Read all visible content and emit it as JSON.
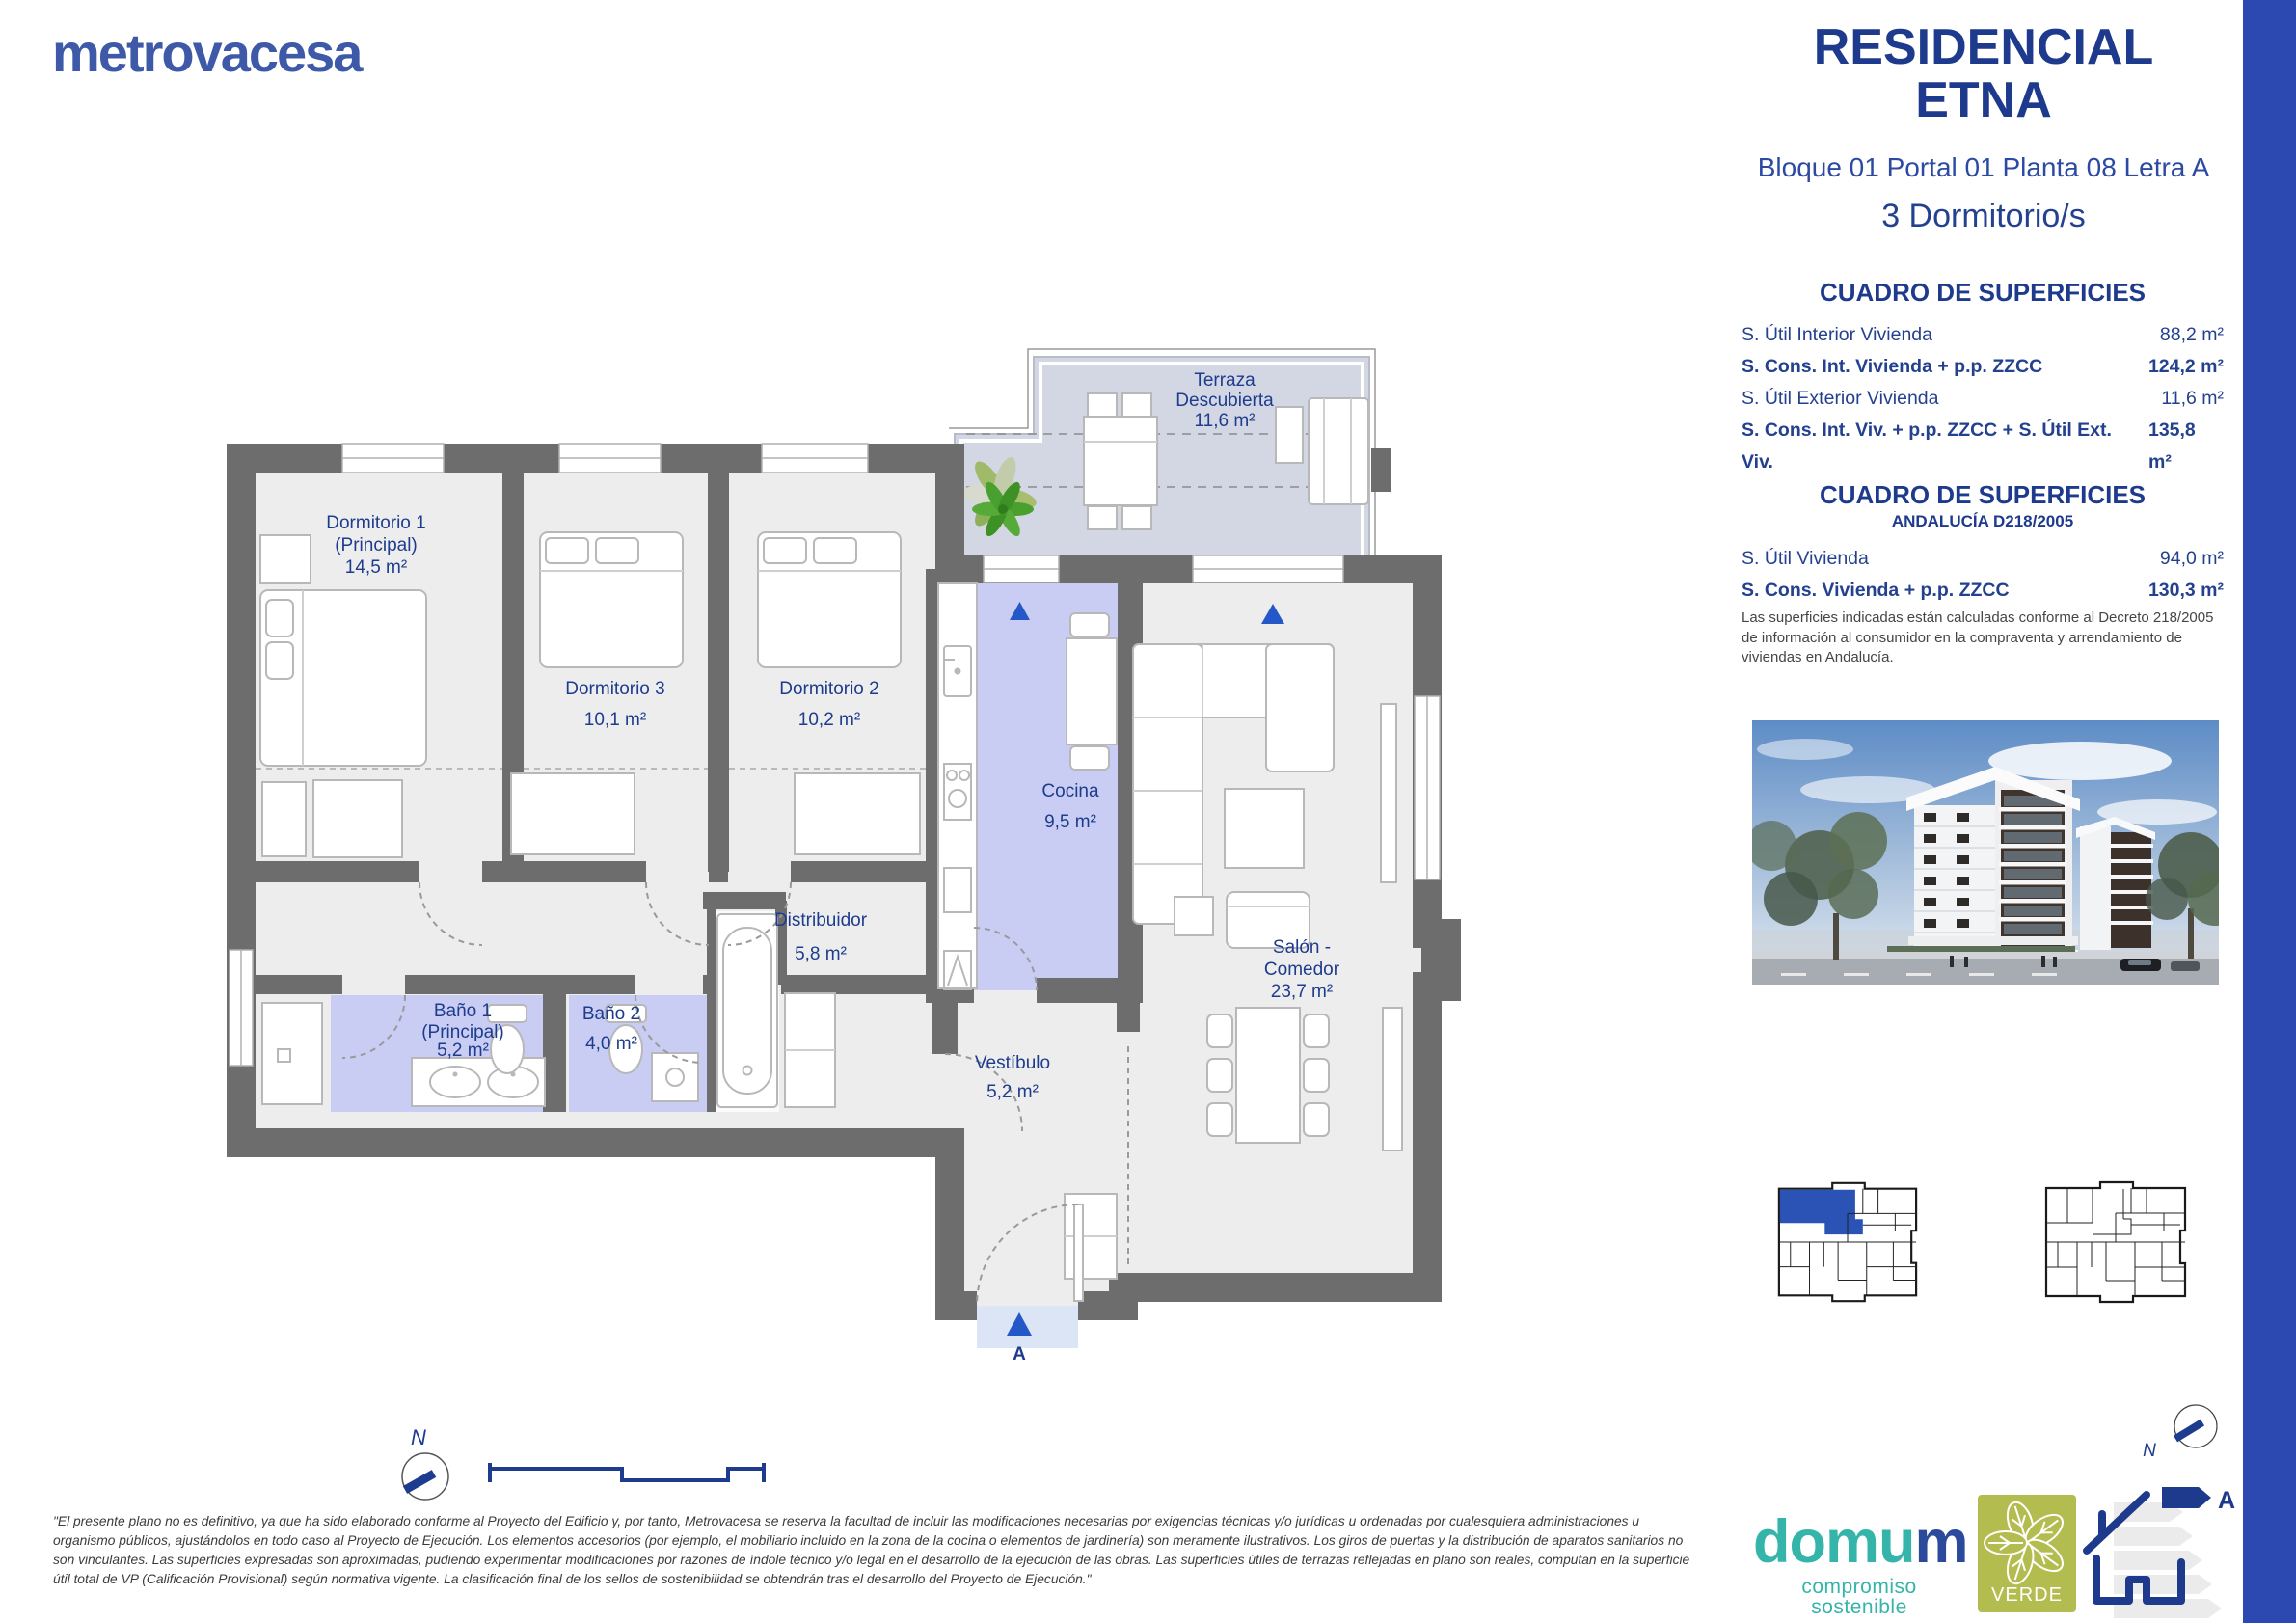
{
  "brand": {
    "logo_text": "metrovacesa"
  },
  "header": {
    "title_line1": "RESIDENCIAL",
    "title_line2": "ETNA",
    "location": "Bloque 01 Portal 01 Planta 08 Letra A",
    "bedrooms": "3 Dormitorio/s"
  },
  "surfaces": {
    "title": "CUADRO DE SUPERFICIES",
    "rows": [
      {
        "label": "S. Útil Interior Vivienda",
        "value": "88,2 m²"
      },
      {
        "label": "S. Cons. Int. Vivienda + p.p. ZZCC",
        "value": "124,2 m²"
      },
      {
        "label": "S. Útil Exterior Vivienda",
        "value": "11,6 m²"
      },
      {
        "label": "S. Cons. Int. Viv. + p.p. ZZCC + S. Útil Ext. Viv.",
        "value": "135,8 m²"
      }
    ]
  },
  "surfaces_andalucia": {
    "title": "CUADRO DE SUPERFICIES",
    "subtitle": "ANDALUCÍA D218/2005",
    "rows": [
      {
        "label": "S. Útil Vivienda",
        "value": "94,0 m²"
      },
      {
        "label": "S. Cons. Vivienda + p.p. ZZCC",
        "value": "130,3 m²"
      }
    ],
    "note": "Las superficies indicadas están calculadas conforme al Decreto 218/2005 de información al consumidor en la compraventa y arrendamiento de viviendas en Andalucía."
  },
  "plan": {
    "rooms": {
      "dormitorio1": {
        "line1": "Dormitorio 1",
        "line2": "(Principal)",
        "area": "14,5 m²"
      },
      "dormitorio3": {
        "name": "Dormitorio 3",
        "area": "10,1 m²"
      },
      "dormitorio2": {
        "name": "Dormitorio 2",
        "area": "10,2 m²"
      },
      "terraza": {
        "line1": "Terraza",
        "line2": "Descubierta",
        "area": "11,6 m²"
      },
      "cocina": {
        "name": "Cocina",
        "area": "9,5 m²"
      },
      "distribuidor": {
        "name": "Distribuidor",
        "area": "5,8 m²"
      },
      "bano1": {
        "line1": "Baño 1",
        "line2": "(Principal)",
        "area": "5,2 m²"
      },
      "bano2": {
        "name": "Baño 2",
        "area": "4,0 m²"
      },
      "salon": {
        "line1": "Salón -",
        "line2": "Comedor",
        "area": "23,7 m²"
      },
      "vestibulo": {
        "name": "Vestíbulo",
        "area": "5,2 m²"
      }
    },
    "entrance_label": "A",
    "north_label": "N"
  },
  "footer": {
    "disclaimer_l1": "\"El presente plano no es definitivo, ya que ha sido elaborado conforme al Proyecto del Edificio y, por tanto, Metrovacesa se reserva la facultad de incluir las modificaciones necesarias por exigencias técnicas y/o jurídicas u ordenadas por cualesquiera administraciones u",
    "disclaimer_l2": "organismo públicos, ajustándolos en todo caso al Proyecto de Ejecución. Los elementos accesorios (por ejemplo, el mobiliario incluido en la zona de la cocina o elementos de jardinería) son meramente ilustrativos. Los giros de puertas y la distribución de aparatos sanitarios no",
    "disclaimer_l3": "son vinculantes. Las superficies expresadas son aproximadas, pudiendo experimentar modificaciones por razones de índole técnico y/o legal en el desarrollo de la ejecución de las obras. Las superficies útiles de terrazas reflejadas en plano son reales, computan en la superficie",
    "disclaimer_l4": "útil total de VP (Calificación Provisional) según normativa vigente. La clasificación final de los sellos de sostenibilidad se obtendrán tras el desarrollo del Proyecto de Ejecución.\""
  },
  "logos": {
    "domum_part1": "domu",
    "domum_part2": "m",
    "domum_tagline": "compromiso sostenible",
    "verde": "VERDE",
    "energy_label": "A",
    "north_label": "N"
  },
  "colors": {
    "navy": "#1e3a8d",
    "accent_bar": "#2c49b2",
    "wall_gray": "#6d6d6d",
    "floor": "#ededed",
    "wet_floor": "#c9cdf3",
    "terrace_floor": "#d3d7e3",
    "triangle_blue": "#2458c8",
    "domum_teal": "#35b5a9",
    "verde_green": "#b3bc4e",
    "keyplan_highlight": "#2b52b5"
  }
}
